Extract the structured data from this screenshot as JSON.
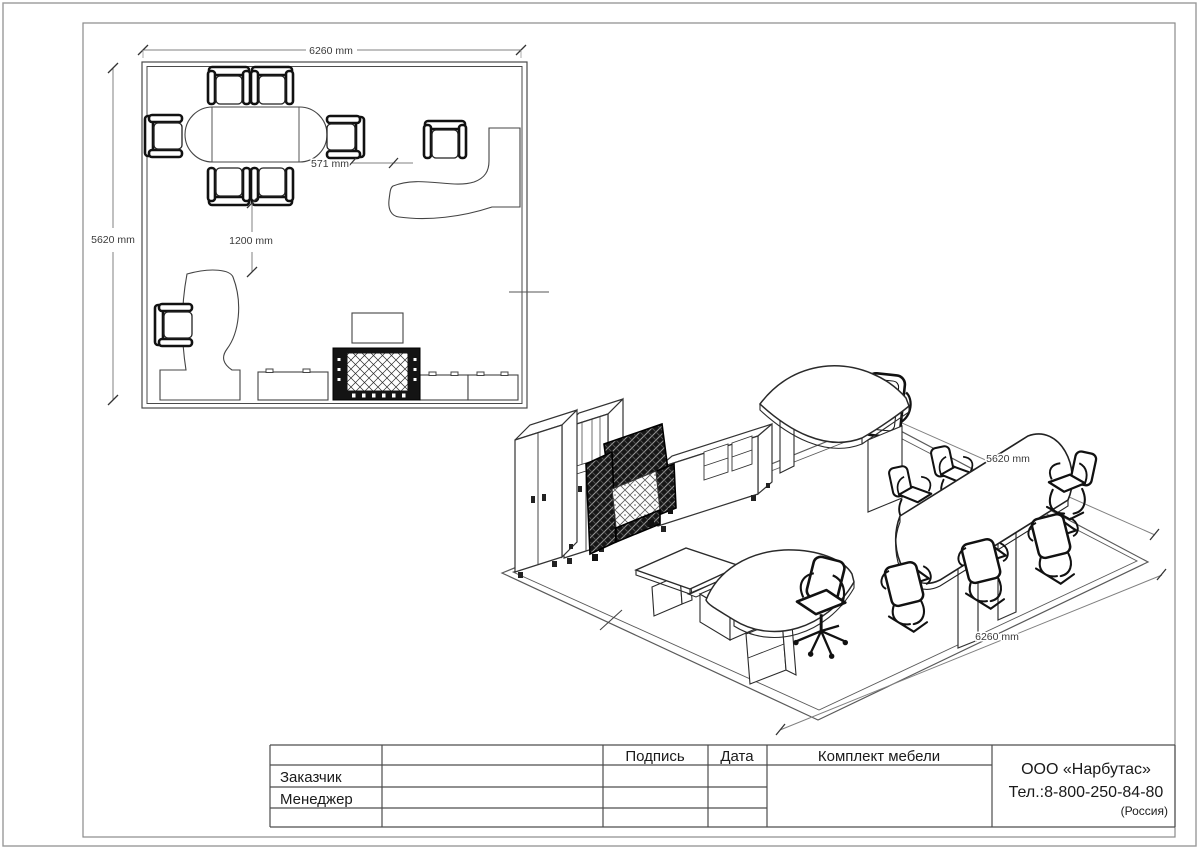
{
  "drawing": {
    "plan": {
      "dim_width": "6260 mm",
      "dim_height": "5620 mm",
      "dim_gap": "571 mm",
      "dim_clearance": "1200 mm"
    },
    "iso": {
      "dim_depth": "5620 mm",
      "dim_width": "6260 mm"
    },
    "title_block": {
      "col_signature": "Подпись",
      "col_date": "Дата",
      "col_set": "Комплект мебели",
      "row_customer": "Заказчик",
      "row_manager": "Менеджер",
      "company_name": "ООО «Нарбутас»",
      "company_phone": "Тел.:8-800-250-84-80",
      "company_country": "(Россия)"
    }
  }
}
